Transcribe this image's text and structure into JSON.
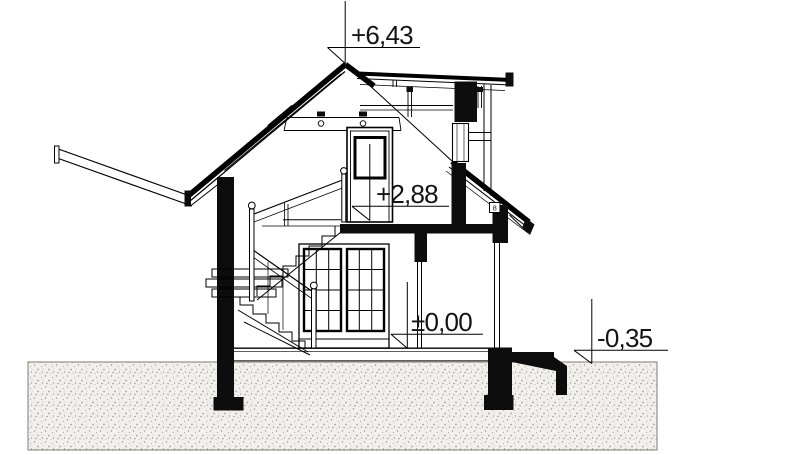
{
  "drawing": {
    "kind": "architectural cross-section of a house",
    "levels": {
      "ridge": "+6,43",
      "attic_floor": "+2,88",
      "ground_floor": "±0,00",
      "site": "-0,35"
    },
    "details": {
      "wall_plate": "8"
    }
  }
}
